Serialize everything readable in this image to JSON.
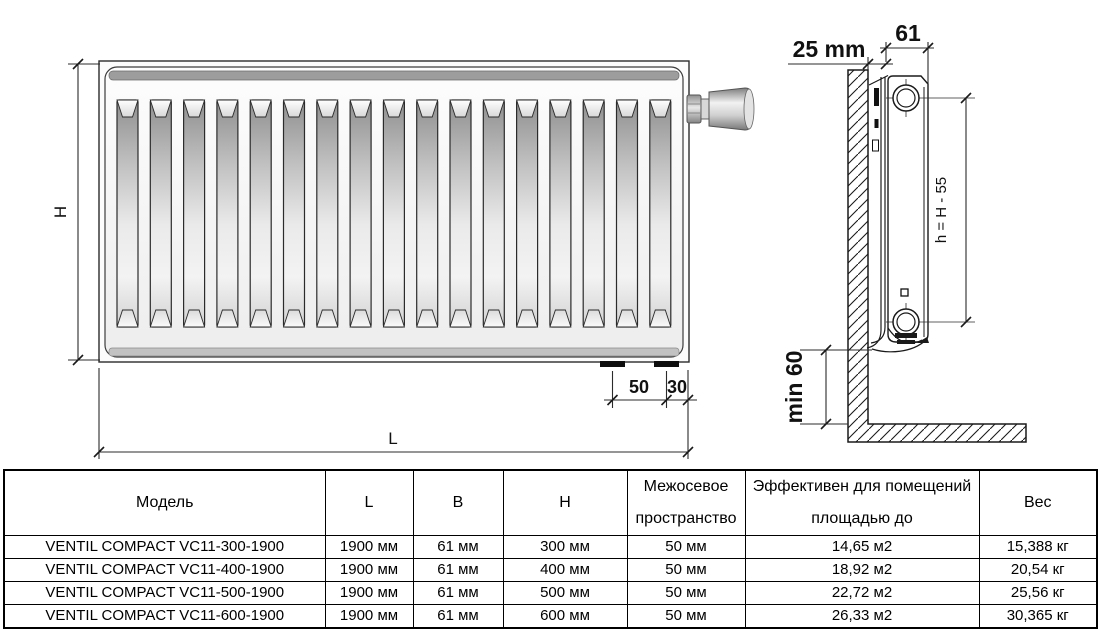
{
  "front_view": {
    "sections": 17,
    "height_label": "H",
    "length_label": "L",
    "stub_spacing_label": "50",
    "stub_edge_label": "30"
  },
  "side_view": {
    "wall_gap_label": "25 mm",
    "depth_label": "61",
    "connection_height_label": "h = H - 55",
    "floor_clearance_label": "min 60"
  },
  "table": {
    "headers": [
      "Модель",
      "L",
      "B",
      "H",
      "Межосевое\nпространство",
      "Эффективен для помещений\nплощадью до",
      "Вес"
    ],
    "rows": [
      [
        "VENTIL COMPACT VC11-300-1900",
        "1900 мм",
        "61 мм",
        "300 мм",
        "50 мм",
        "14,65 м2",
        "15,388 кг"
      ],
      [
        "VENTIL COMPACT VC11-400-1900",
        "1900 мм",
        "61 мм",
        "400 мм",
        "50 мм",
        "18,92 м2",
        "20,54 кг"
      ],
      [
        "VENTIL COMPACT VC11-500-1900",
        "1900 мм",
        "61 мм",
        "500 мм",
        "50 мм",
        "22,72 м2",
        "25,56 кг"
      ],
      [
        "VENTIL COMPACT VC11-600-1900",
        "1900 мм",
        "61 мм",
        "600 мм",
        "50 мм",
        "26,33 м2",
        "30,365 кг"
      ]
    ]
  },
  "colors": {
    "line": "#1a1a1a",
    "panel_face": "#f7f7f7",
    "band_top": "#9d9d9d",
    "band_bottom": "#c2c2c2",
    "stub": "#0d0d0d"
  }
}
